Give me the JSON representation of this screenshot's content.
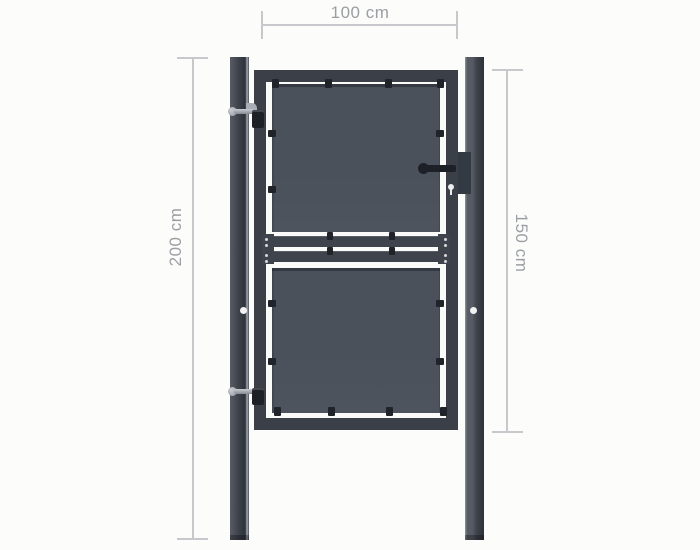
{
  "diagram": {
    "name": "garden-gate-dimension-diagram",
    "measurements": {
      "width_label": "100 cm",
      "post_height_label": "200 cm",
      "gate_height_label": "150 cm"
    }
  },
  "palette": {
    "bg": "#fcfcfb",
    "inner_bg": "#fafaf9",
    "line": "#c6c8cb",
    "label": "#9b9ea4",
    "post": "#3d424b",
    "post_light": "#575c64",
    "post_highlight": "#90969c",
    "post_shadow": "#2e333b",
    "frame": "#3a3f48",
    "panel": "#4b515b",
    "panel_edge": "#343943",
    "rail": "#3e434c",
    "clip": "#20242a",
    "silver": "#a9aeb5",
    "silver_light": "#c9cdd2",
    "hardware": "#1d2127",
    "lock_plate": "#343a43",
    "bolt_hole": "#f2f2f2"
  }
}
